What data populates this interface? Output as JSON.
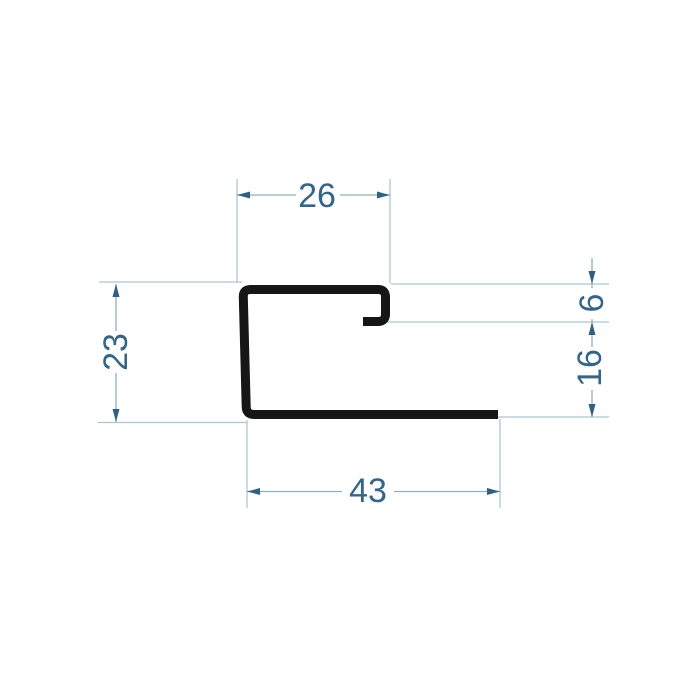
{
  "drawing": {
    "kind": "profile-cross-section-dimensioned-drawing",
    "labels": {
      "top_width": "26",
      "left_height": "23",
      "hook_depth": "6",
      "right_lower_height": "16",
      "bottom_width": "43"
    }
  },
  "colors": {
    "background": "#ffffff",
    "profile_stroke": "#161616",
    "dimension_text": "#31658a",
    "arrow": "#2d6186",
    "dimension_line": "#8fafbe",
    "extension_line": "#aac6d2",
    "text_mask": "#ffffff"
  }
}
